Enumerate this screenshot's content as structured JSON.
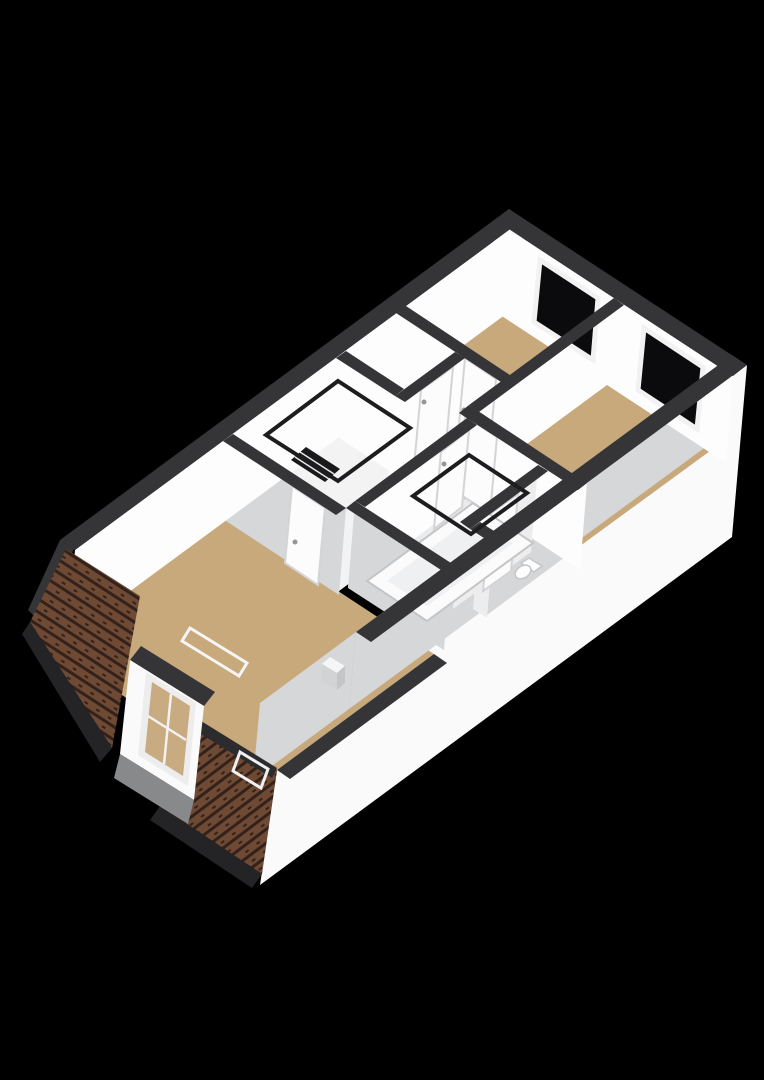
{
  "scene": {
    "kind": "3d-floorplan-render",
    "view": "axonometric-top",
    "background": "#000000"
  },
  "rooms": {
    "bedroom_top": {
      "label": "bedroom-top",
      "floor": "#c8a97b"
    },
    "bedroom_right": {
      "label": "bedroom-right",
      "floor": "#c8a97b"
    },
    "closet": {
      "label": "closet",
      "floor": "#f3f3f4"
    },
    "landing": {
      "label": "landing",
      "floor": "#f3f3f4"
    },
    "bathroom": {
      "label": "bathroom",
      "floor": "#eaebed"
    },
    "toilet_room": {
      "label": "toilet-room",
      "floor": "#d5d6d8"
    },
    "attic_bedroom": {
      "label": "attic-bedroom",
      "floor": "#c8a97b"
    }
  },
  "colors": {
    "background": "#000000",
    "wallCap": "#353537",
    "wallCapDeep": "#2c2c2e",
    "faceBright": "#fdfdfd",
    "faceSoft": "#ededee",
    "faceGray": "#d6d7d9",
    "facade": "#fafafa",
    "roofTile": "#6e4a35",
    "roofStripe": "#33211a",
    "roofDark": "#242426",
    "dormerGlass": "#c8ab80",
    "grayUnderDormer": "#88898b",
    "windowGlass": "#0b0b0d",
    "windowFrame": "#f2f2f2",
    "railing": "#1d1d1f",
    "stairDark": "#19191b",
    "stepLine": "#e8e8e8",
    "door": "#fcfcfc",
    "doorEdge": "#d4d4d6",
    "handle": "#96969a",
    "tub": "#fbfbfc",
    "tubInner": "#eff0f2",
    "fixture": "#fdfdfe",
    "fixtureEdge": "#c4c5c7",
    "chimneyTop": "#f6f6f7",
    "chimneySide": "#d2d3d5",
    "sillWhite": "#f5f5f6",
    "skylight": "#f0f0f0"
  },
  "fixtures": [
    "bathtub",
    "toilet",
    "staircase-void",
    "bath-roof-window",
    "attic-roof-window",
    "dormer-window",
    "chimney",
    "end-window-1",
    "end-window-2"
  ]
}
